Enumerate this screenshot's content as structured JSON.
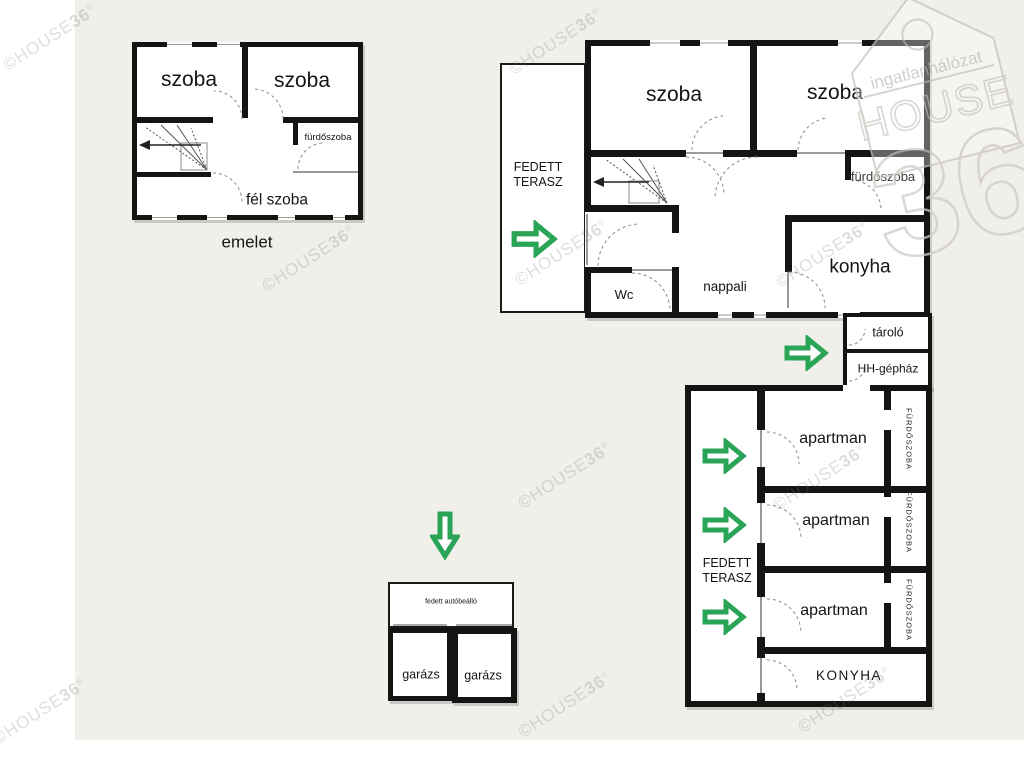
{
  "watermark": {
    "prefix": "©HOUSE",
    "number": "36",
    "reg": "®"
  },
  "logo": {
    "network": "ingatlanhálózat",
    "brand": "HOUSE",
    "number": "36"
  },
  "colors": {
    "arrow_green": "#2aa558",
    "wall_black": "#141414",
    "background_beige": "#f0efea",
    "watermark_gray": "#cfccc6"
  },
  "upper_floor": {
    "caption": "emelet",
    "room_left": "szoba",
    "room_right": "szoba",
    "bathroom": "fürdőszoba",
    "half_room": "fél szoba"
  },
  "ground_floor": {
    "terrace_line1": "FEDETT",
    "terrace_line2": "TERASZ",
    "room_left": "szoba",
    "room_right": "szoba",
    "bathroom": "fürdőszoba",
    "wc": "Wc",
    "living_room": "nappali",
    "kitchen": "konyha",
    "storage": "tároló",
    "boiler_room": "HH-gépház"
  },
  "apartments": {
    "terrace_line1": "FEDETT",
    "terrace_line2": "TERASZ",
    "apartment1": "apartman",
    "apartment2": "apartman",
    "apartment3": "apartman",
    "bathroom1": "FÜRDŐSZOBA",
    "bathroom2": "FÜRDŐSZOBA",
    "bathroom3": "FÜRDŐSZOBA",
    "kitchen": "KONYHA"
  },
  "garage": {
    "carport": "fedett autóbeálló",
    "garage_left": "garázs",
    "garage_right": "garázs"
  }
}
